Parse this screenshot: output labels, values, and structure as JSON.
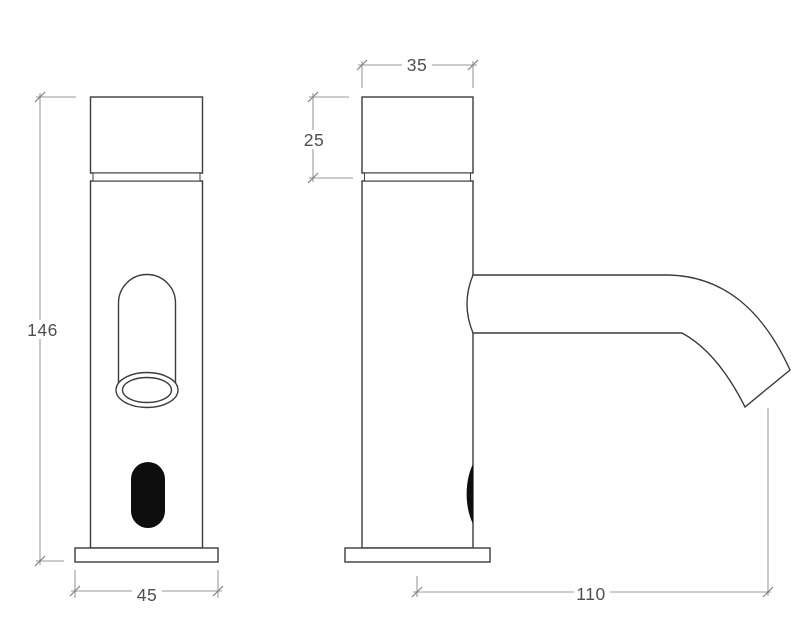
{
  "drawing": {
    "dimension_labels": {
      "front_height": "146",
      "front_base_width": "45",
      "side_top_width": "35",
      "side_cap_height": "25",
      "side_spout_reach": "110"
    },
    "colors": {
      "background": "#ffffff",
      "object_line": "#3c3c3c",
      "dimension_line": "#9a9a9a",
      "tick_line": "#7a7a7a",
      "label_text": "#4f4f4f",
      "sensor_window": "#0e0e0e"
    }
  }
}
